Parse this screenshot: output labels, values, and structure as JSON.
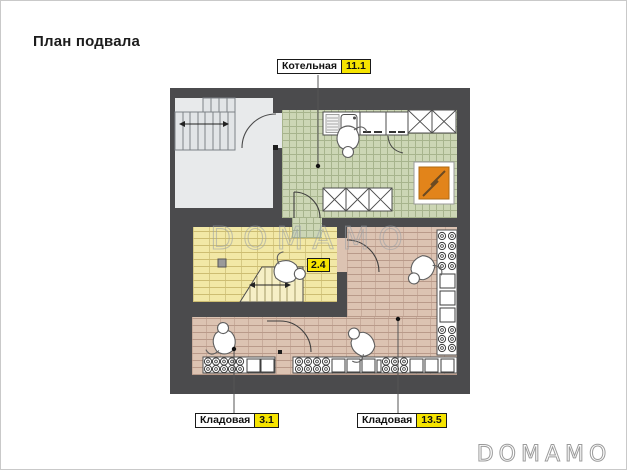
{
  "page": {
    "title": "План подвала"
  },
  "watermarks": {
    "center": "DOMAMO",
    "corner": "DOMAMO"
  },
  "plan": {
    "rooms": [
      {
        "id": "boiler",
        "label": "Котельная",
        "area": "11.1"
      },
      {
        "id": "understairs",
        "label": "",
        "area": "2.4"
      },
      {
        "id": "storage-small",
        "label": "Кладовая",
        "area": "3.1"
      },
      {
        "id": "storage-large",
        "label": "Кладовая",
        "area": "13.5"
      }
    ],
    "features": [
      "staircase",
      "stair-direction-arrow",
      "sink-counter",
      "wall-cabinets",
      "boiler-equipment-box",
      "lightning-symbol",
      "storage-shelves-jars",
      "storage-shelves-boxes",
      "door-swings",
      "person-figures",
      "floor-drain"
    ],
    "colors": {
      "wall": "#4b4b4d",
      "hall_floor": "#e8eaeb",
      "tile_floor": "#ccd6b5",
      "wood_yellow": "#f2e8a6",
      "wood_pink": "#dcc3b2",
      "badge_yellow": "#f6e400",
      "equipment_orange": "#e2841a"
    }
  }
}
